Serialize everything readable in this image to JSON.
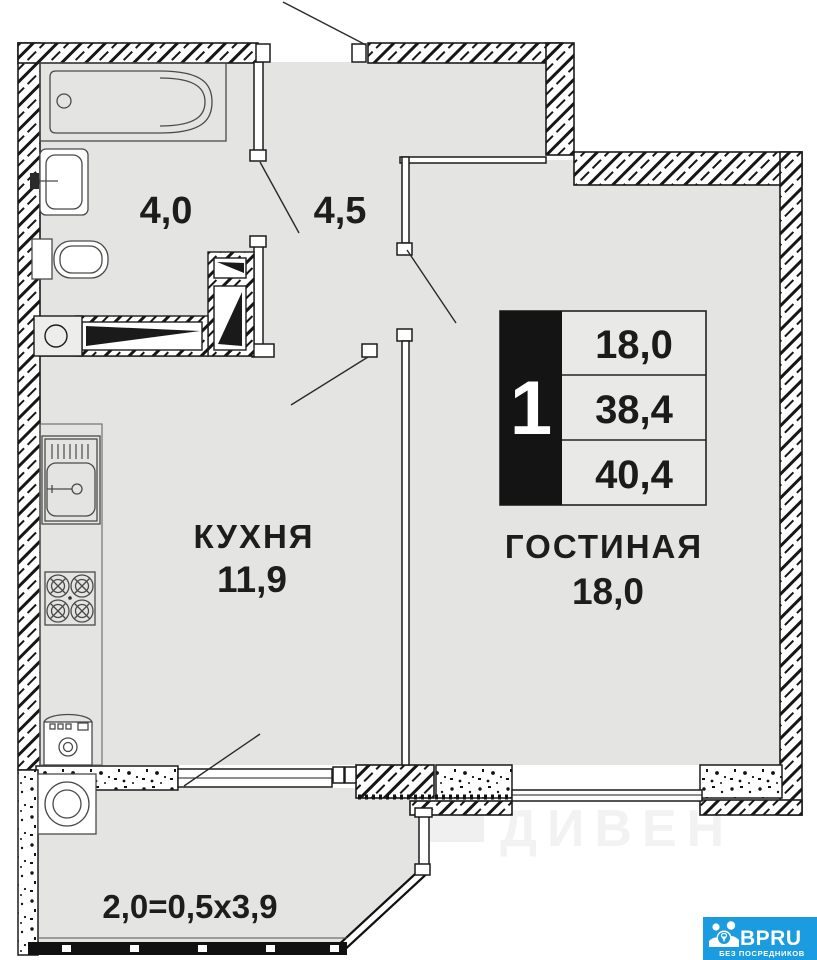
{
  "floor_plan": {
    "info_box": {
      "rooms_count": "1",
      "rows": [
        "18,0",
        "38,4",
        "40,4"
      ]
    },
    "rooms": {
      "bathroom_area": "4,0",
      "hallway_area": "4,5",
      "kitchen_name": "КУХНЯ",
      "kitchen_area": "11,9",
      "living_name": "ГОСТИНАЯ",
      "living_area": "18,0",
      "balcony_formula": "2,0=0,5x3,9"
    },
    "watermark": "ДИВЕН",
    "colors": {
      "floor": "#e4e4e2",
      "wall_line": "#1c1c1c",
      "info_box_black": "#141414",
      "brand_blue": "#1b9ce0"
    }
  },
  "branding": {
    "name": "BPRU",
    "tagline": "БЕЗ ПОСРЕДНИКОВ"
  }
}
